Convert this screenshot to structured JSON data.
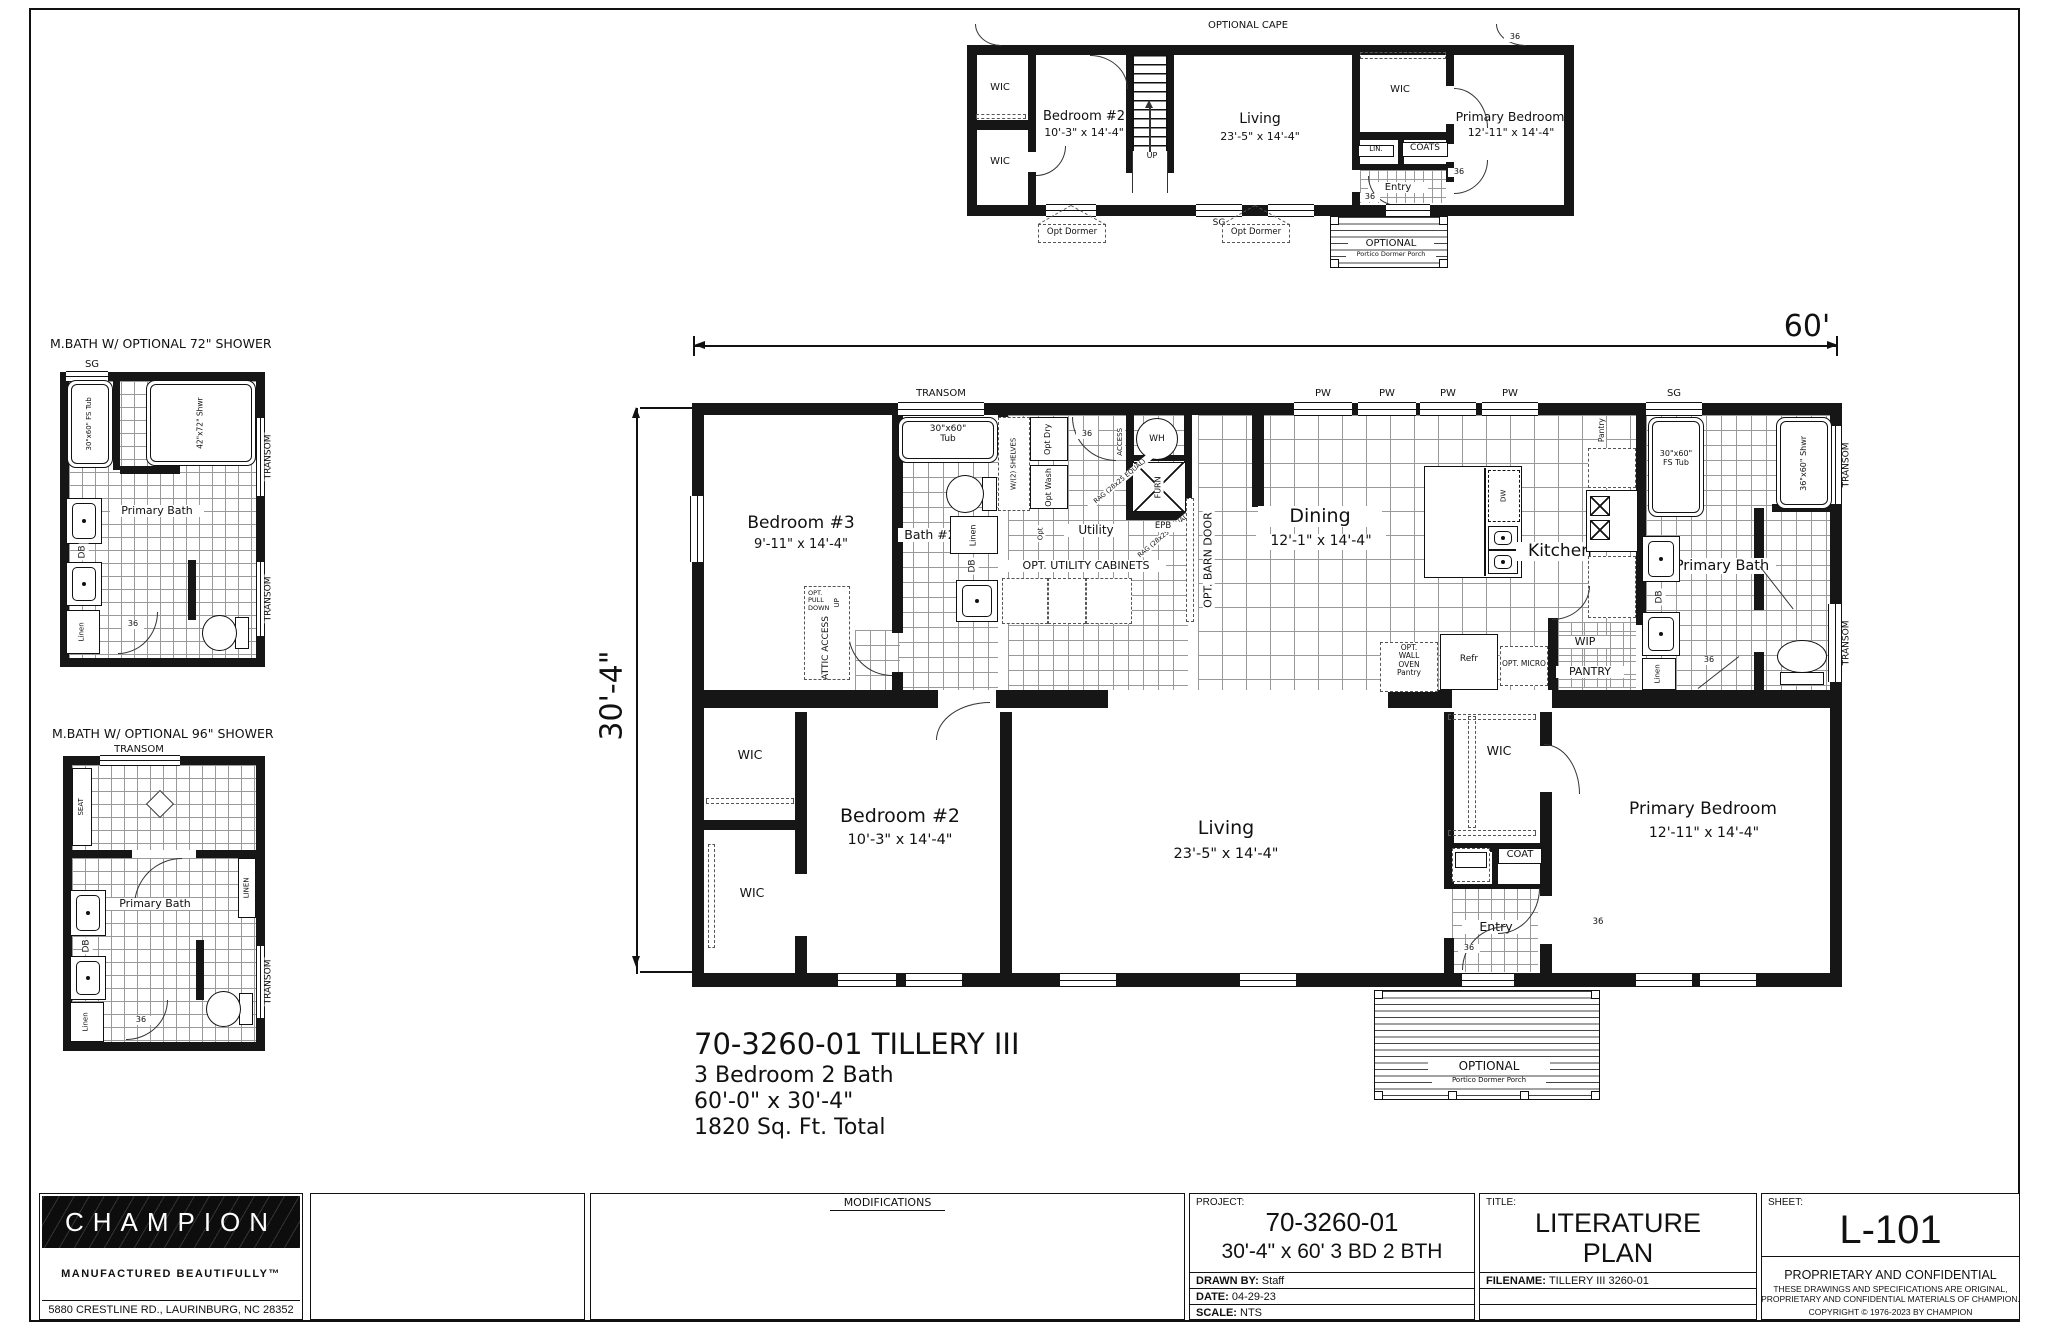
{
  "t": {
    "optional_cape": "OPTIONAL CAPE",
    "wic": "WIC",
    "up": "UP",
    "lin": "LIN.",
    "coats": "COATS",
    "coat": "COAT",
    "entry": "Entry",
    "d36": "36",
    "sg": "SG",
    "pw": "PW",
    "db": "DB",
    "dw": "DW",
    "wh": "WH",
    "furn": "FURN",
    "epb": "EPB",
    "access": "ACCESS",
    "opt": "Opt",
    "transom": "TRANSOM",
    "linen": "Linen",
    "linen_caps": "LINEN",
    "seat": "SEAT",
    "pantry": "Pantry",
    "pantry_caps": "PANTRY",
    "wip": "WIP",
    "refr": "Refr",
    "opt_micro": "OPT. MICRO",
    "opt_dormer": "Opt Dormer",
    "optional": "OPTIONAL",
    "portico": "Portico Dormer Porch",
    "bedroom2": "Bedroom #2",
    "bedroom2_dim": "10'-3\" x 14'-4\"",
    "bedroom3": "Bedroom #3",
    "bedroom3_dim": "9'-11\" x 14'-4\"",
    "living": "Living",
    "living_dim": "23'-5\" x 14'-4\"",
    "dining": "Dining",
    "dining_dim": "12'-1\" x 14'-4\"",
    "kitchen": "Kitchen",
    "primary_bedroom": "Primary Bedroom",
    "primary_bedroom_dim": "12'-11\" x 14'-4\"",
    "primary_bath": "Primary Bath",
    "bath2": "Bath #2",
    "tub": "30\"x60\"\nTub",
    "fs_tub": "30\"x60\"\nFS Tub",
    "fs_tub_line": "30\"x60\" FS Tub",
    "shwr36": "36\"x60\" Shwr",
    "shwr42": "42\"x72\" Shwr",
    "rag": "RAG (28x25 EQUAL)",
    "utility": "Utility",
    "opt_dry": "Opt Dry",
    "opt_wash": "Opt Wash",
    "shelves": "W/(2) SHELVES",
    "opt_util_cab": "OPT. UTILITY CABINETS",
    "barn": "OPT. BARN DOOR",
    "attic_pull": "OPT.\nPULL\nDOWN",
    "attic_access": "ATTIC ACCESS",
    "oven": "OPT.\nWALL\nOVEN\nPantry",
    "dim60": "60'",
    "dim304": "30'-4\"",
    "bath72_title": "M.BATH W/ OPTIONAL 72\" SHOWER",
    "bath96_title": "M.BATH W/ OPTIONAL 96\" SHOWER"
  },
  "plan_title": {
    "line1": "70-3260-01 TILLERY III",
    "line2": "3 Bedroom  2 Bath",
    "line3": "60'-0\" x 30'-4\"",
    "line4": "1820 Sq. Ft.  Total"
  },
  "titleblock": {
    "brand": "CHAMPION",
    "tagline": "MANUFACTURED BEAUTIFULLY™",
    "address": "5880 CRESTLINE RD., LAURINBURG, NC 28352",
    "modifications": "MODIFICATIONS",
    "project_label": "PROJECT:",
    "project_number": "70-3260-01",
    "project_desc": "30'-4\" x 60' 3 BD 2 BTH",
    "drawn_by_label": "DRAWN BY:",
    "drawn_by_value": "Staff",
    "date_label": "DATE:",
    "date_value": "04-29-23",
    "scale_label": "SCALE: ",
    "scale_value": "NTS",
    "title_label": "TITLE:",
    "title_line1": "LITERATURE",
    "title_line2": "PLAN",
    "filename_label": "FILENAME:",
    "filename_value": "TILLERY III 3260-01",
    "sheet_label": "SHEET:",
    "sheet_number": "L-101",
    "prop_title": "PROPRIETARY AND CONFIDENTIAL",
    "prop_line1": "THESE DRAWINGS AND SPECIFICATIONS ARE ORIGINAL,",
    "prop_line2": "PROPRIETARY AND CONFIDENTIAL MATERIALS OF CHAMPION.",
    "prop_line3": "COPYRIGHT © 1976-2023 BY CHAMPION"
  }
}
